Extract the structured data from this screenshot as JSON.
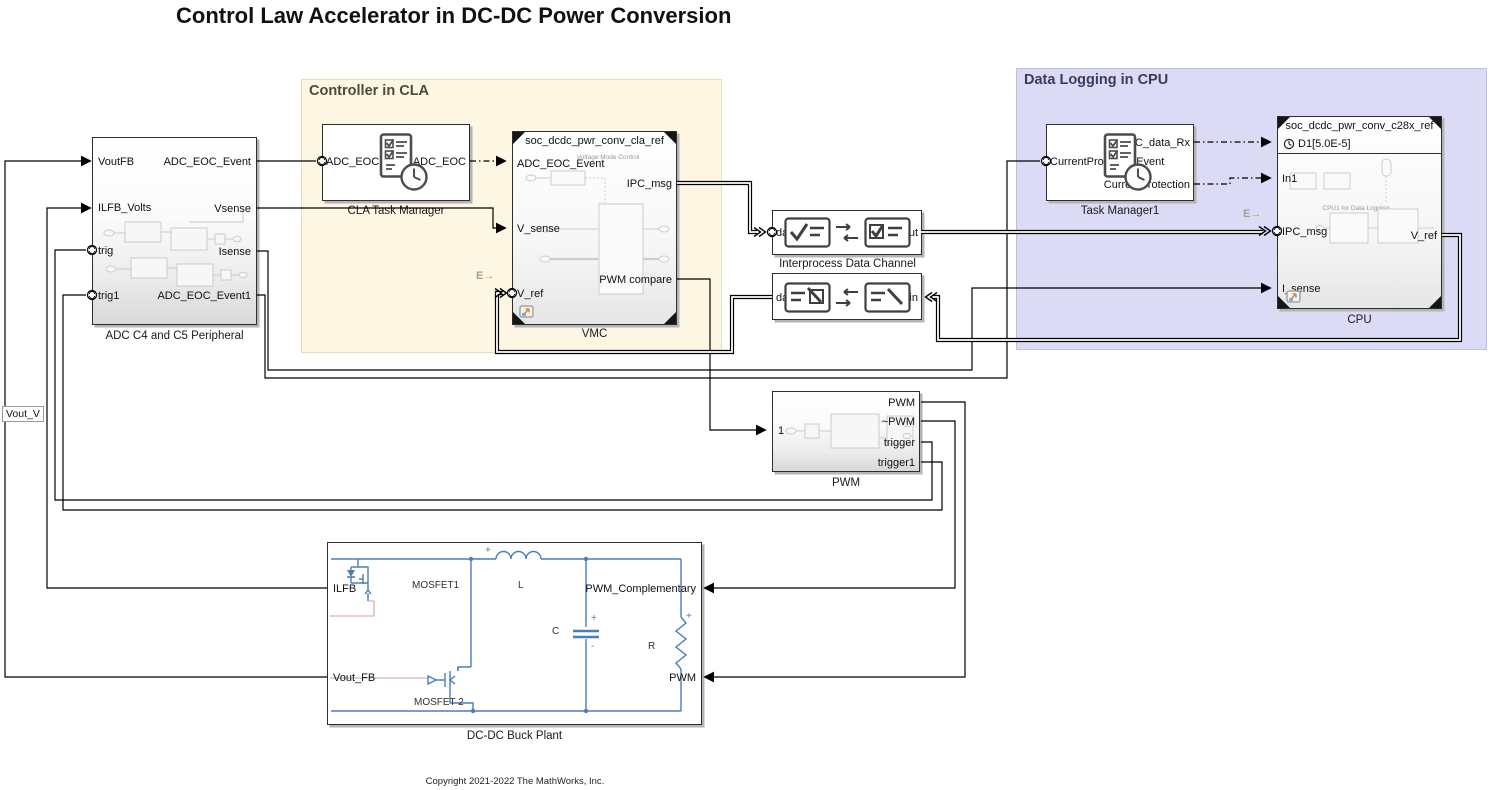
{
  "title": "Control Law Accelerator in DC-DC Power Conversion",
  "copyright": "Copyright 2021-2022 The MathWorks, Inc.",
  "colors": {
    "cla_region_fill": "#fdf6e3",
    "cla_region_border": "#e6dcbe",
    "cpu_region_fill": "#dbdbf6",
    "cpu_region_border": "#bfbfe2",
    "circuit_blue": "#4a7ebb",
    "rate_arrow_orange": "#e2971f",
    "wire": "#000000"
  },
  "regions": {
    "cla": {
      "label": "Controller in CLA"
    },
    "cpu": {
      "label": "Data Logging in CPU"
    }
  },
  "blocks": {
    "adc": {
      "caption": "ADC C4 and C5 Peripheral",
      "inputs": [
        "VoutFB",
        "ILFB_Volts",
        "trig",
        "trig1"
      ],
      "outputs": [
        "ADC_EOC_Event",
        "Vsense",
        "Isense",
        "ADC_EOC_Event1"
      ]
    },
    "cla_tm": {
      "caption": "CLA Task Manager",
      "input": "ADC_EOCEvent",
      "output": "ADC_EOC"
    },
    "vmc": {
      "caption": "VMC",
      "header": "soc_dcdc_pwr_conv_cla_ref",
      "inner_title": "Voltage Mode Control",
      "inputs": [
        "ADC_EOC_Event",
        "V_sense",
        "V_ref"
      ],
      "outputs": [
        "IPC_msg",
        "PWM compare"
      ]
    },
    "ipc1": {
      "caption": "Interprocess Data Channel",
      "left_port": "datain",
      "right_port": "dataout"
    },
    "ipc2": {
      "left_port": "dataout",
      "right_port": "datain"
    },
    "tm1": {
      "caption": "Task Manager1",
      "input": "CurrentProtectionEvent",
      "outputs": [
        "IPC_data_Rx",
        "CurrentProtection"
      ]
    },
    "cpu": {
      "caption": "CPU",
      "header": "soc_dcdc_pwr_conv_c28x_ref",
      "rate": "D1[5.0E-5]",
      "inner_title": "CPU1 for Data Logging",
      "inputs": [
        "In1",
        "IPC_msg",
        "I_sense"
      ],
      "output": "V_ref"
    },
    "pwm": {
      "caption": "PWM",
      "input": "1",
      "outputs": [
        "PWM",
        "~PWM",
        "trigger",
        "trigger1"
      ]
    },
    "plant": {
      "caption": "DC-DC Buck Plant",
      "left_ports": [
        "ILFB",
        "Vout_FB"
      ],
      "right_ports": [
        "PWM_Complementary",
        "PWM"
      ],
      "components": {
        "mosfet1": "MOSFET1",
        "mosfet2": "MOSFET 2",
        "inductor": "L",
        "capacitor": "C",
        "resistor": "R"
      }
    }
  },
  "labels": {
    "vout_v": "Vout_V",
    "rate_marker": "E",
    "rate_arrow": "→",
    "plus": "+",
    "minus": "-"
  }
}
